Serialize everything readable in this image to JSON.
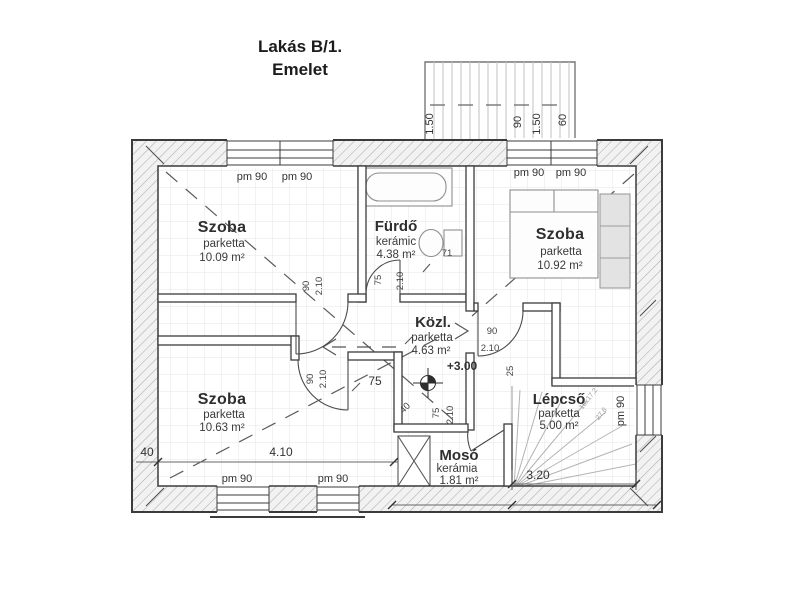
{
  "title": {
    "line1": "Lakás B/1.",
    "line2": "Emelet"
  },
  "rooms": {
    "szoba_tl": {
      "name": "Szoba",
      "finish": "parketta",
      "area": "10.09 m²"
    },
    "furdo": {
      "name": "Fürdő",
      "finish": "kerámic",
      "area": "4.38 m²"
    },
    "szoba_tr": {
      "name": "Szoba",
      "finish": "parketta",
      "area": "10.92 m²"
    },
    "kozl": {
      "name": "Közl.",
      "finish": "parketta",
      "area": "4.63 m²"
    },
    "szoba_bl": {
      "name": "Szoba",
      "finish": "parketta",
      "area": "10.63 m²"
    },
    "moso": {
      "name": "Mosó",
      "finish": "kerámia",
      "area": "1.81 m²"
    },
    "lepcso": {
      "name": "Lépcső",
      "finish": "parketta",
      "area": "5.00 m²"
    }
  },
  "level_marker": "+3.00",
  "window_label": "pm 90",
  "dims": {
    "room_width": "4.10",
    "stair_width": "3.20",
    "left_offset": "40",
    "terrace_150": "1.50",
    "terrace_90": "90",
    "terrace_60": "60"
  },
  "door_labels": {
    "w90": "90",
    "w75": "75",
    "w71": "71",
    "w25": "25",
    "w40": "40",
    "h210": "2.10",
    "passage75": "75"
  },
  "stair_note": {
    "line1": "18x17,2",
    "line2": "27,8"
  },
  "colors": {
    "wall_line": "#3b3b3b",
    "hatch": "#adadad",
    "grid": "#e6e6e6"
  }
}
